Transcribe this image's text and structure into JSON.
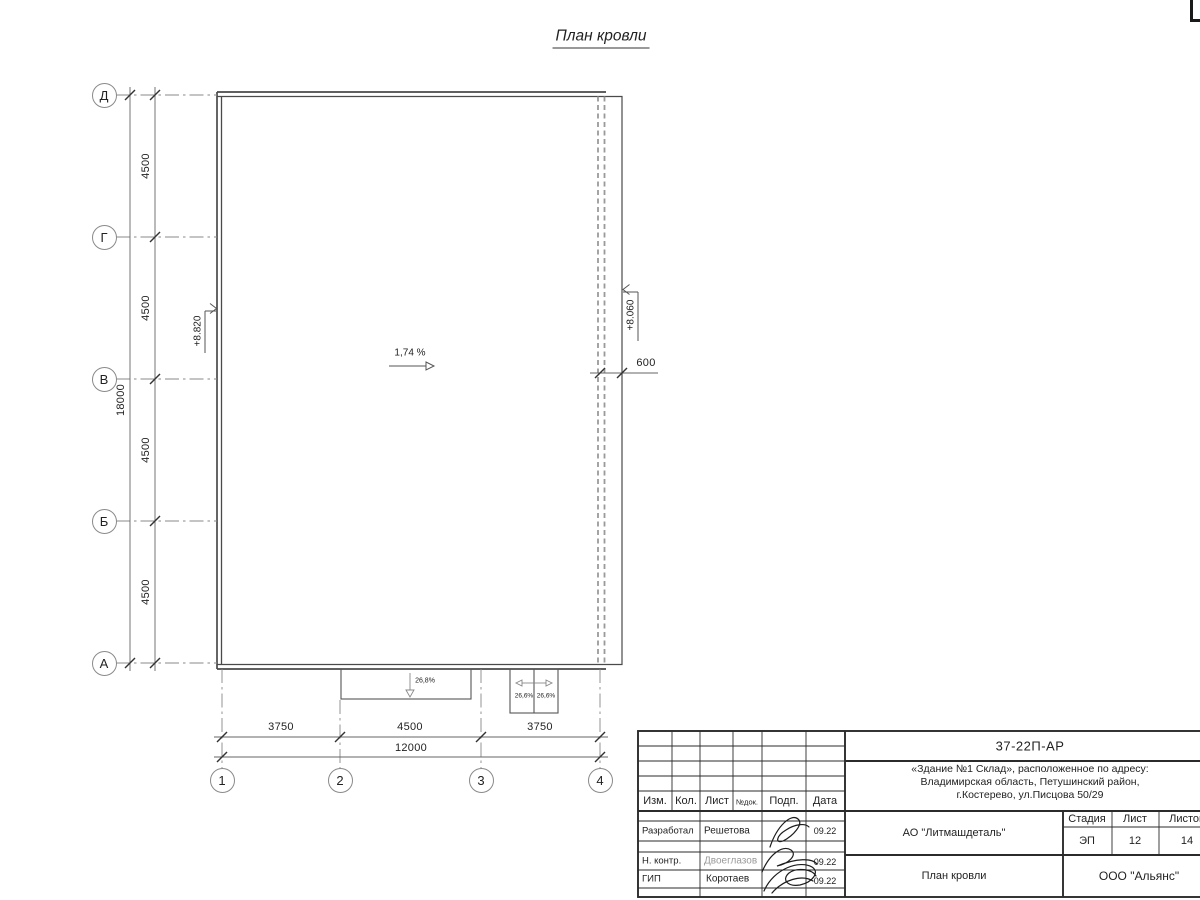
{
  "sheet": {
    "title": "План кровли"
  },
  "axes": {
    "rows": [
      {
        "label": "Д"
      },
      {
        "label": "Г"
      },
      {
        "label": "В"
      },
      {
        "label": "Б"
      },
      {
        "label": "А"
      }
    ],
    "cols": [
      {
        "label": "1"
      },
      {
        "label": "2"
      },
      {
        "label": "3"
      },
      {
        "label": "4"
      }
    ]
  },
  "dims": {
    "left_segments": [
      "4500",
      "4500",
      "4500",
      "4500"
    ],
    "left_total": "18000",
    "bottom_segments": [
      "3750",
      "4500",
      "3750"
    ],
    "bottom_total": "12000",
    "overhang": "600"
  },
  "annotations": {
    "roof_slope": "1,74 %",
    "canopy_slope": "26,8%",
    "canopy2_slope_left": "26,6%",
    "canopy2_slope_right": "26,6%",
    "elev_left": "+8.820",
    "elev_right": "+8.060"
  },
  "title_block": {
    "doc_number": "37-22П-АР",
    "project_lines": [
      "«Здание №1 Склад», расположенное по адресу:",
      "Владимирская область, Петушинский район,",
      "г.Костерево, ул.Писцова 50/29"
    ],
    "client": "АО \"Литмашдеталь\"",
    "drawing_name": "План кровли",
    "company": "ООО \"Альянс\"",
    "stage_label": "Стадия",
    "stage_value": "ЭП",
    "sheet_label": "Лист",
    "sheet_value": "12",
    "sheets_label": "Листов",
    "sheets_value": "14",
    "header": [
      "Изм.",
      "Кол.",
      "Лист",
      "№док.",
      "Подп.",
      "Дата"
    ],
    "sign_rows": [
      {
        "role": "Разработал",
        "name": "Решетова",
        "date": "09.22"
      },
      {
        "role": "Н. контр.",
        "name": "Двоеглазов",
        "date": "09.22"
      },
      {
        "role": "ГИП",
        "name": "Коротаев",
        "date": "09.22"
      }
    ]
  }
}
